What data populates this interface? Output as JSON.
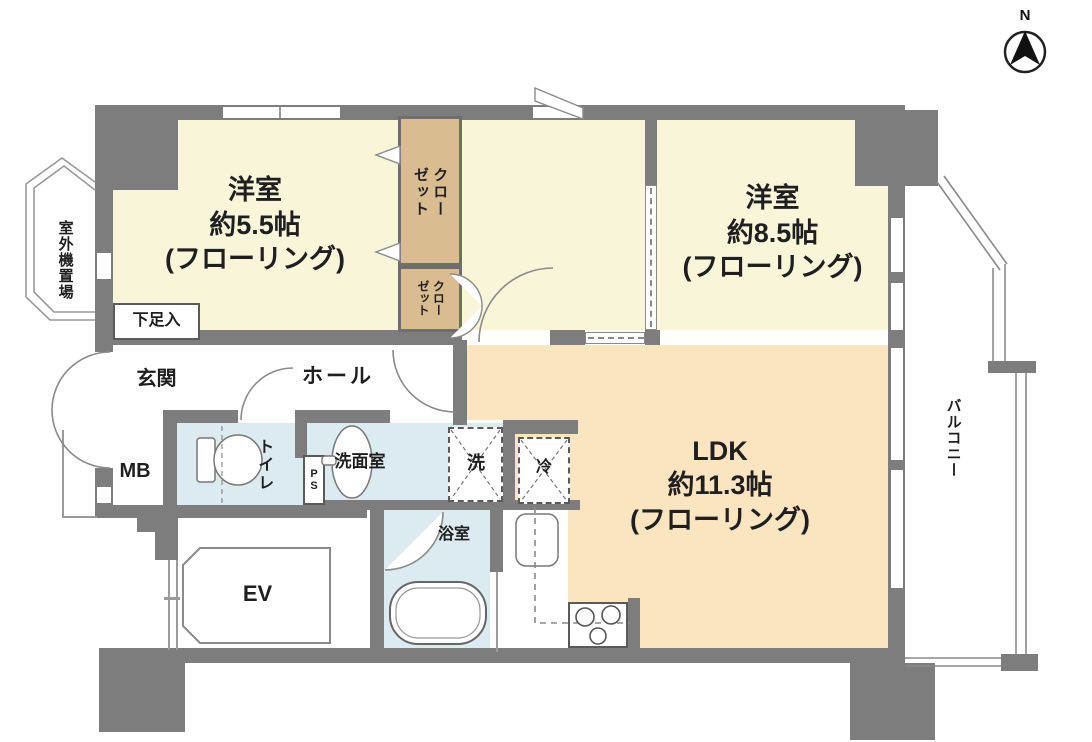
{
  "plan": {
    "compass_label": "N",
    "rooms": {
      "western_room_small": {
        "name": "洋室",
        "size": "約5.5帖",
        "floor": "(フローリング)"
      },
      "western_room_large": {
        "name": "洋室",
        "size": "約8.5帖",
        "floor": "(フローリング)"
      },
      "ldk": {
        "name": "LDK",
        "size": "約11.3帖",
        "floor": "(フローリング)"
      },
      "closet_upper": {
        "label": "クロー\nゼット"
      },
      "closet_lower": {
        "label": "クロー\nゼット"
      },
      "entrance": {
        "label": "玄関"
      },
      "shoe_cabinet": {
        "label": "下足入"
      },
      "hall": {
        "label": "ホール"
      },
      "meter_box": {
        "label": "MB"
      },
      "toilet": {
        "label": "トイレ"
      },
      "pipe_shaft": {
        "label": "PS"
      },
      "washroom": {
        "label": "洗面室"
      },
      "washing_machine": {
        "label": "洗"
      },
      "refrigerator": {
        "label": "冷"
      },
      "bathroom": {
        "label": "浴室"
      },
      "elevator": {
        "label": "EV"
      },
      "balcony": {
        "label": "バルコニー"
      },
      "outdoor_unit_space": {
        "label": "室外機置場"
      }
    },
    "colors": {
      "wall": "#7d7d7d",
      "room_floor": "#f8f5d9",
      "ldk_floor": "#fbe4c0",
      "closet": "#d9bd90",
      "wet_area": "#dcebf0",
      "line": "#8a8a8a",
      "text": "#1f1f1f"
    }
  }
}
